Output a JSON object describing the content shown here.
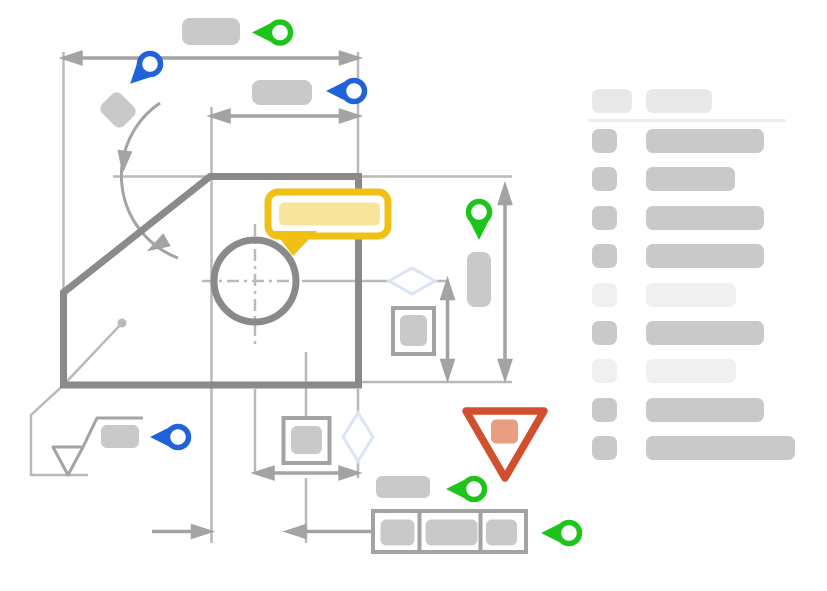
{
  "illustration": {
    "kind": "engineering-drawing-annotation-wireframe",
    "visible_text": "none"
  },
  "colors": {
    "pin_green": "#1cc41c",
    "pin_blue": "#1f62da",
    "bubble_border": "#f0c114",
    "bubble_fill": "#f8e49c",
    "warning_stroke": "#d14f2d",
    "warning_fill": "#eb9d84",
    "outline_strong": "#8a8a8a",
    "dimension": "#a3a3a3",
    "extension": "#b9b9b9",
    "block_mid": "#c9c9c9",
    "block_light": "#f0f0f0",
    "block_header": "#e9e9e9",
    "separator": "#ececec",
    "diamond": "#dbe4f6"
  },
  "markers": [
    {
      "name": "pin-top-dimension",
      "color": "green",
      "direction": "left"
    },
    {
      "name": "pin-overall-width",
      "color": "blue",
      "direction": "down-left"
    },
    {
      "name": "pin-inner-width",
      "color": "blue",
      "direction": "left"
    },
    {
      "name": "pin-height-dimension",
      "color": "green",
      "direction": "down"
    },
    {
      "name": "pin-surface-finish",
      "color": "blue",
      "direction": "left"
    },
    {
      "name": "pin-fcf-label",
      "color": "green",
      "direction": "left"
    },
    {
      "name": "pin-fcf",
      "color": "green",
      "direction": "left"
    }
  ],
  "legend": {
    "header": {
      "icon_w": 40,
      "bar_w": 66,
      "h": 24
    },
    "row_h": 24,
    "row_step": 38.4,
    "rows_top": 44,
    "icon_left": 4,
    "bar_left": 58,
    "rows": [
      {
        "tone": "strong",
        "icon_w": 25,
        "bar_w": 118
      },
      {
        "tone": "strong",
        "icon_w": 25,
        "bar_w": 89
      },
      {
        "tone": "strong",
        "icon_w": 25,
        "bar_w": 118
      },
      {
        "tone": "strong",
        "icon_w": 25,
        "bar_w": 118
      },
      {
        "tone": "muted",
        "icon_w": 25,
        "bar_w": 90
      },
      {
        "tone": "strong",
        "icon_w": 25,
        "bar_w": 118
      },
      {
        "tone": "muted",
        "icon_w": 25,
        "bar_w": 90
      },
      {
        "tone": "strong",
        "icon_w": 25,
        "bar_w": 118
      },
      {
        "tone": "strong",
        "icon_w": 25,
        "bar_w": 149
      }
    ]
  }
}
